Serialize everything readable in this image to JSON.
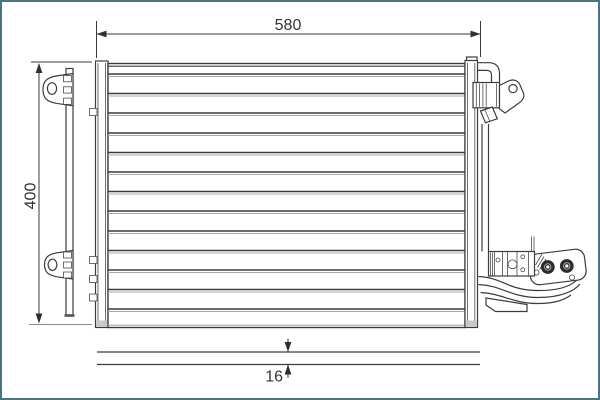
{
  "frame": {
    "color": "#4d7386"
  },
  "drawing": {
    "dimensions": {
      "width": {
        "label": "580"
      },
      "height": {
        "label": "400"
      },
      "depth": {
        "label": "16"
      }
    },
    "colors": {
      "line": "#3c3c3c",
      "line_gray": "#a8a8a8",
      "shade": "#c9c9c9",
      "text": "#333333",
      "frame": "#4d7386"
    }
  }
}
